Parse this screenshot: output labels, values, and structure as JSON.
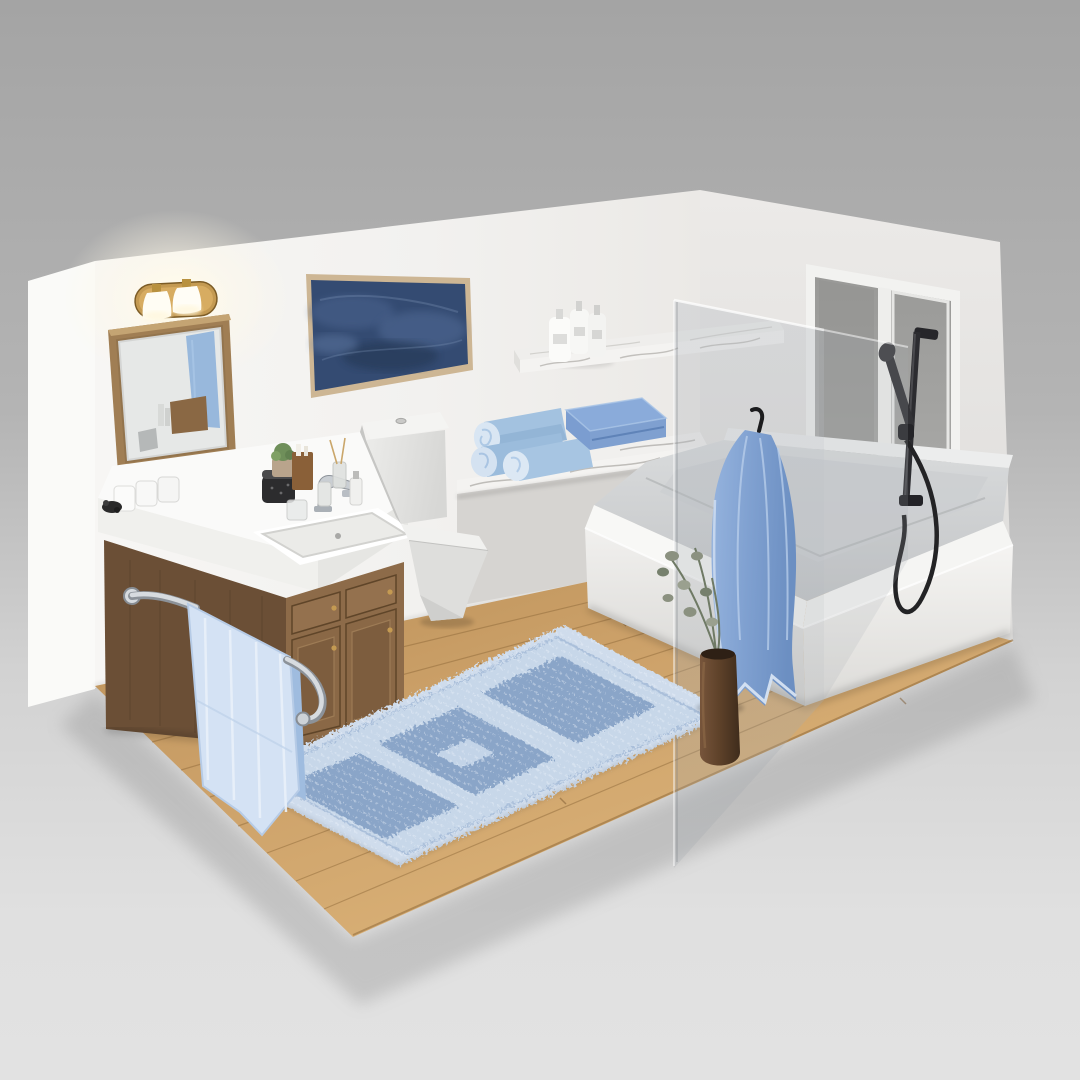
{
  "image_type": "3d-isometric-render",
  "subject": "modern bathroom interior cutaway with two walls, wood floor on gray studio backdrop",
  "palette": {
    "backdrop_top": "#a4a4a4",
    "backdrop_bottom": "#e0e0e0",
    "wall_back": "#f3f2f0",
    "wall_right": "#e6e5e3",
    "wall_edge": "#fafaf8",
    "floor_light": "#dbb377",
    "floor_dark": "#b98e56",
    "floor_seam": "#8a6536",
    "cabinet_wood": "#7a5a3e",
    "cabinet_wood_dark": "#5f4630",
    "drawer_wood": "#8d6b49",
    "counter_white": "#fafaf9",
    "ceramic_white": "#e9e9e7",
    "tub_white": "#f0efed",
    "basin_gray": "#ced0d2",
    "marble_white": "#f4f3f1",
    "marble_vein": "#b5b3af",
    "glass_tint": "rgba(168,174,180,0.30)",
    "towel_cornflower": "#7fa0d0",
    "towel_powder": "#d4e2f4",
    "towel_roll": "#a3c2e0",
    "rug_light": "#c7d7e9",
    "rug_dark": "#8aa5c8",
    "fixture_black": "#26262a",
    "chrome": "#d7dbdf",
    "brass": "#c49a52",
    "art_navy": "#344b72",
    "frame_tan": "#cdb694",
    "plant_sage": "#8b9180",
    "vase_brown": "#5d4129"
  },
  "scene": {
    "walls": {
      "back_wall": "white wall with sconce, mirror, framed art",
      "right_wall": "white wall with window",
      "left_edge": "bright wall end-cap strip"
    },
    "floor": {
      "material": "light oak plank wood",
      "backdrop": "gray seamless studio gradient"
    },
    "objects": [
      {
        "name": "vanity-light-sconce",
        "description": "brass oval two-lamp sconce with white glass shades, lit",
        "color": "#c49a52"
      },
      {
        "name": "mirror",
        "description": "wood framed rectangular mirror reflecting blue towel and counter items",
        "color": "#a07e54"
      },
      {
        "name": "wall-art",
        "description": "wide framed abstract navy canvas in thin tan frame",
        "color": "#344b72"
      },
      {
        "name": "vanity-cabinet",
        "description": "walnut wood vanity with 2 drawers and 2 doors, brass knobs, white counter",
        "color": "#7a5a3e"
      },
      {
        "name": "sink",
        "description": "white rectangular drop-in sink with chrome faucet",
        "color": "#fafaf9"
      },
      {
        "name": "counter-items",
        "items": [
          "three white canisters",
          "black exfoliating jar",
          "glass tumbler",
          "succulent in pot",
          "wood candle holder",
          "reed diffuser",
          "soap bottles",
          "glass bottle"
        ]
      },
      {
        "name": "towel-bar",
        "description": "chrome bar mounted on cabinet side with powder-blue hand towel",
        "color": "#d7dbdf"
      },
      {
        "name": "toilet",
        "description": "modern square one-piece toilet, light gray ceramic",
        "color": "#e9e9e7"
      },
      {
        "name": "floating-shelf",
        "description": "white marble shelf holding 3 white pump bottles",
        "count_bottles": 3,
        "color": "#f4f3f1"
      },
      {
        "name": "bench-ledge",
        "description": "marble-topped half wall ledge holding towels",
        "color": "#f4f3f1"
      },
      {
        "name": "rolled-towels",
        "description": "three rolled light blue towels",
        "count": 3,
        "color": "#a3c2e0"
      },
      {
        "name": "folded-towel",
        "description": "folded cornflower blue towel stack",
        "color": "#7fa0d0"
      },
      {
        "name": "glass-shower-panel",
        "description": "translucent glass screen between tub and room",
        "color": "rgba(168,174,180,0.30)"
      },
      {
        "name": "hanging-towel",
        "description": "cornflower blue bath towel on black hook over glass",
        "color": "#7fa0d0"
      },
      {
        "name": "bathtub",
        "description": "large white alcove soaking tub with wide rim",
        "color": "#f0efed"
      },
      {
        "name": "hand-shower",
        "description": "matte black handheld shower on slide bar with coiled hose",
        "color": "#26262a"
      },
      {
        "name": "window",
        "description": "white framed two-pane window on right wall",
        "color": "#f2f2f0"
      },
      {
        "name": "vase-plant",
        "description": "brown ceramic vase with eucalyptus stems on floor",
        "color": "#5d4129"
      },
      {
        "name": "area-rug",
        "description": "blue chenille runner rug with dark square patches and light border",
        "color": "#8aa5c8"
      }
    ]
  }
}
